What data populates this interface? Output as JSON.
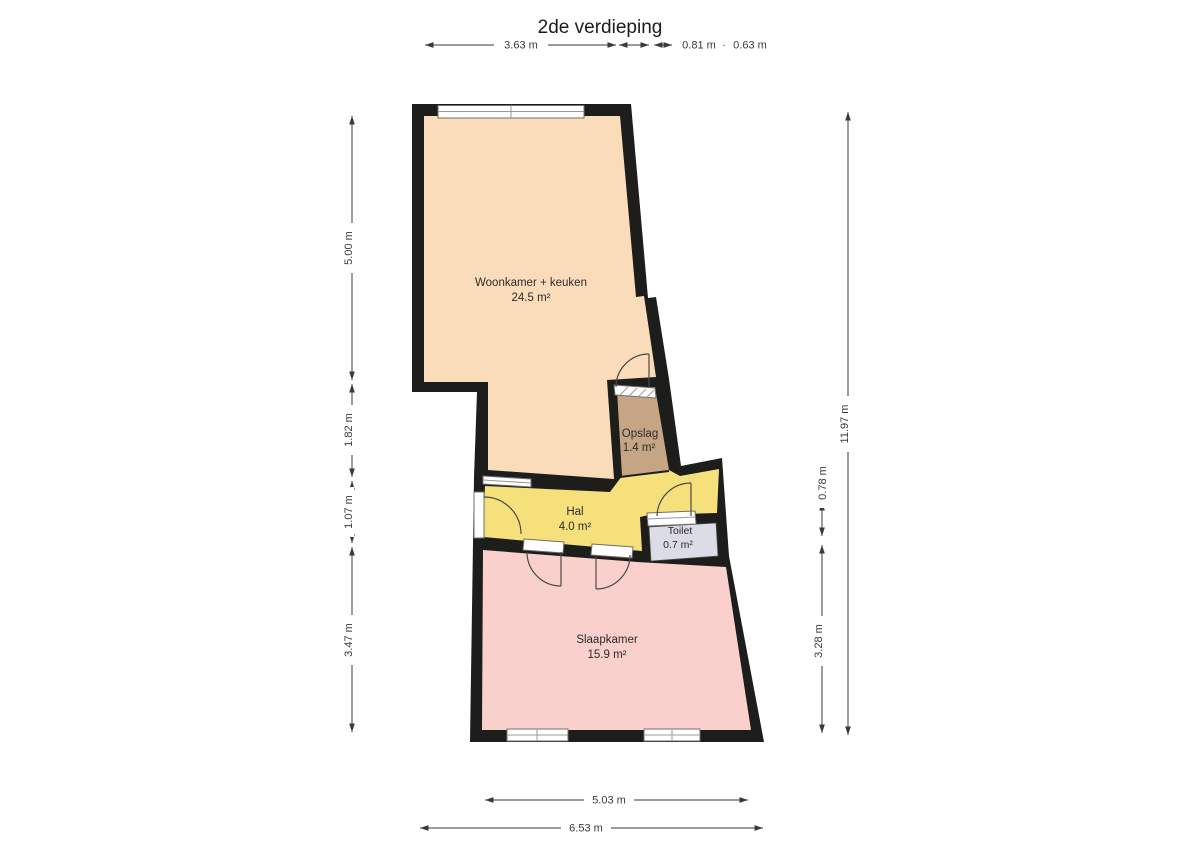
{
  "title": "2de verdieping",
  "rooms": {
    "woonkamer": {
      "name": "Woonkamer + keuken",
      "area": "24.5 m²",
      "color": "#fbdcba"
    },
    "opslag": {
      "name": "Opslag",
      "area": "1.4 m²",
      "color": "#c5a584"
    },
    "hal": {
      "name": "Hal",
      "area": "4.0 m²",
      "color": "#f6e07c"
    },
    "toilet": {
      "name": "Toilet",
      "area": "0.7 m²",
      "color": "#dcdce6"
    },
    "slaapkamer": {
      "name": "Slaapkamer",
      "area": "15.9 m²",
      "color": "#f9d0cb"
    }
  },
  "dimensions": {
    "top": {
      "d1": "3.63 m",
      "d2": "0.81 m",
      "sep": "·",
      "d3": "0.63 m"
    },
    "left": {
      "d1": "5.00 m",
      "d2": "1.82 m",
      "d3": "1.07 m",
      "d4": "3.47 m"
    },
    "right": {
      "total": "11.97 m",
      "d1": "0.78 m",
      "d2": "3.28 m"
    },
    "bottom": {
      "inner": "5.03 m",
      "total": "6.53 m"
    }
  },
  "colors": {
    "wall": "#1d1d1b",
    "background": "#ffffff"
  }
}
